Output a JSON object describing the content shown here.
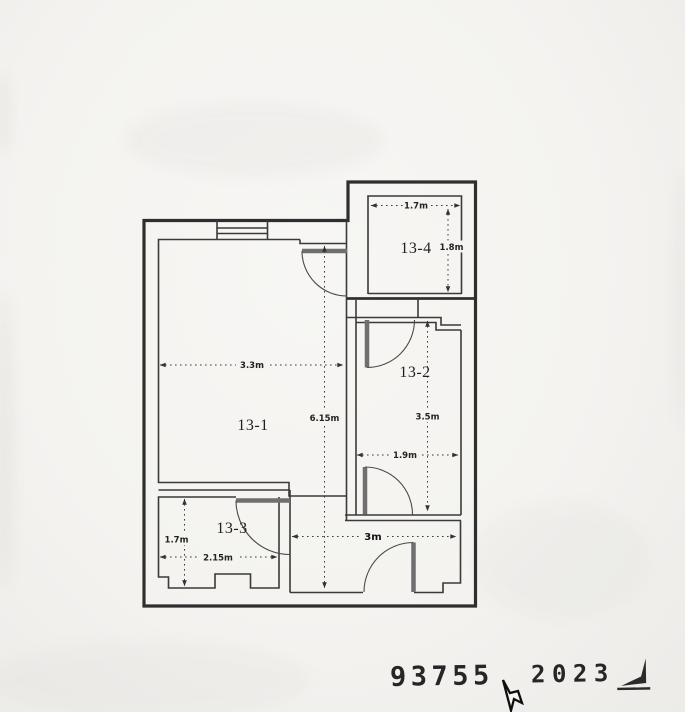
{
  "plan": {
    "rooms": [
      {
        "id": "13-1",
        "label": "13-1"
      },
      {
        "id": "13-2",
        "label": "13-2"
      },
      {
        "id": "13-3",
        "label": "13-3"
      },
      {
        "id": "13-4",
        "label": "13-4"
      }
    ],
    "dimensions": [
      {
        "label": "3.3m"
      },
      {
        "label": "6.15m"
      },
      {
        "label": "1.7m"
      },
      {
        "label": "1.8m"
      },
      {
        "label": "3.5m"
      },
      {
        "label": "1.9m"
      },
      {
        "label": "3m"
      },
      {
        "label": "1.7m"
      },
      {
        "label": "2.15m"
      }
    ]
  },
  "stamp": {
    "left_number": "93755",
    "right_number": "2023"
  },
  "icons": {
    "cursor": "mouse-pointer-icon",
    "mark": "stamp-corner-mark-icon"
  },
  "colors": {
    "ink": "#2e2e2e",
    "door": "#6f6f6f",
    "paper": "#f4f3f0"
  }
}
